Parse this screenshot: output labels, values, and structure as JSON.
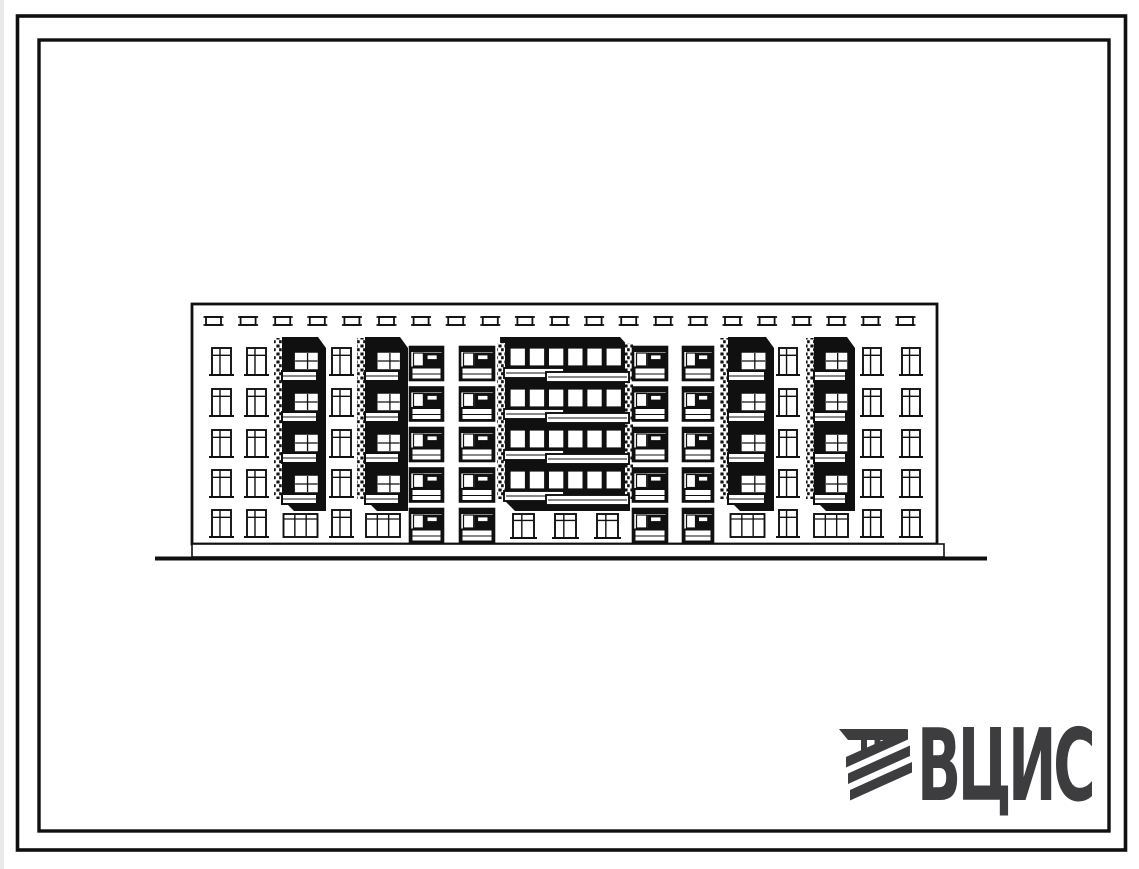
{
  "page": {
    "background": "#ffffff",
    "ink": "#101010",
    "scan_edge_color": "#e9e9e9"
  },
  "logo": {
    "text": "ВЦИС",
    "color": "#3d3d3f"
  },
  "drawing": {
    "subject": "five-storey residential building front elevation",
    "facade": {
      "x": 192,
      "y": 304,
      "w": 745,
      "h": 240,
      "floors": 5,
      "floor_tops": [
        348,
        389,
        430,
        470,
        510
      ],
      "window_height": 27,
      "vents": {
        "count": 21,
        "x0": 206,
        "y": 317,
        "w": 15,
        "h": 8,
        "spacing": 34.6
      },
      "plinth": {
        "x": 192,
        "y": 544,
        "w": 752,
        "h": 13
      },
      "ground_line": {
        "x1": 155,
        "x2": 987,
        "y": 558.5,
        "stroke_width": 4
      },
      "bays": [
        {
          "type": "window",
          "x": 212,
          "w": 19
        },
        {
          "type": "window",
          "x": 247,
          "w": 19
        },
        {
          "type": "loggia",
          "x": 274,
          "w": 53
        },
        {
          "type": "window",
          "x": 332,
          "w": 19
        },
        {
          "type": "loggia",
          "x": 357,
          "w": 52
        },
        {
          "type": "balcony",
          "x": 410,
          "w": 33
        },
        {
          "type": "balcony",
          "x": 460,
          "w": 34
        },
        {
          "type": "central",
          "x": 497,
          "w": 136
        },
        {
          "type": "balcony",
          "x": 633,
          "w": 34
        },
        {
          "type": "balcony",
          "x": 683,
          "w": 30
        },
        {
          "type": "loggia",
          "x": 720,
          "w": 55
        },
        {
          "type": "window",
          "x": 779,
          "w": 18
        },
        {
          "type": "loggia",
          "x": 806,
          "w": 50
        },
        {
          "type": "window",
          "x": 863,
          "w": 18
        },
        {
          "type": "window",
          "x": 902,
          "w": 18
        }
      ]
    }
  }
}
